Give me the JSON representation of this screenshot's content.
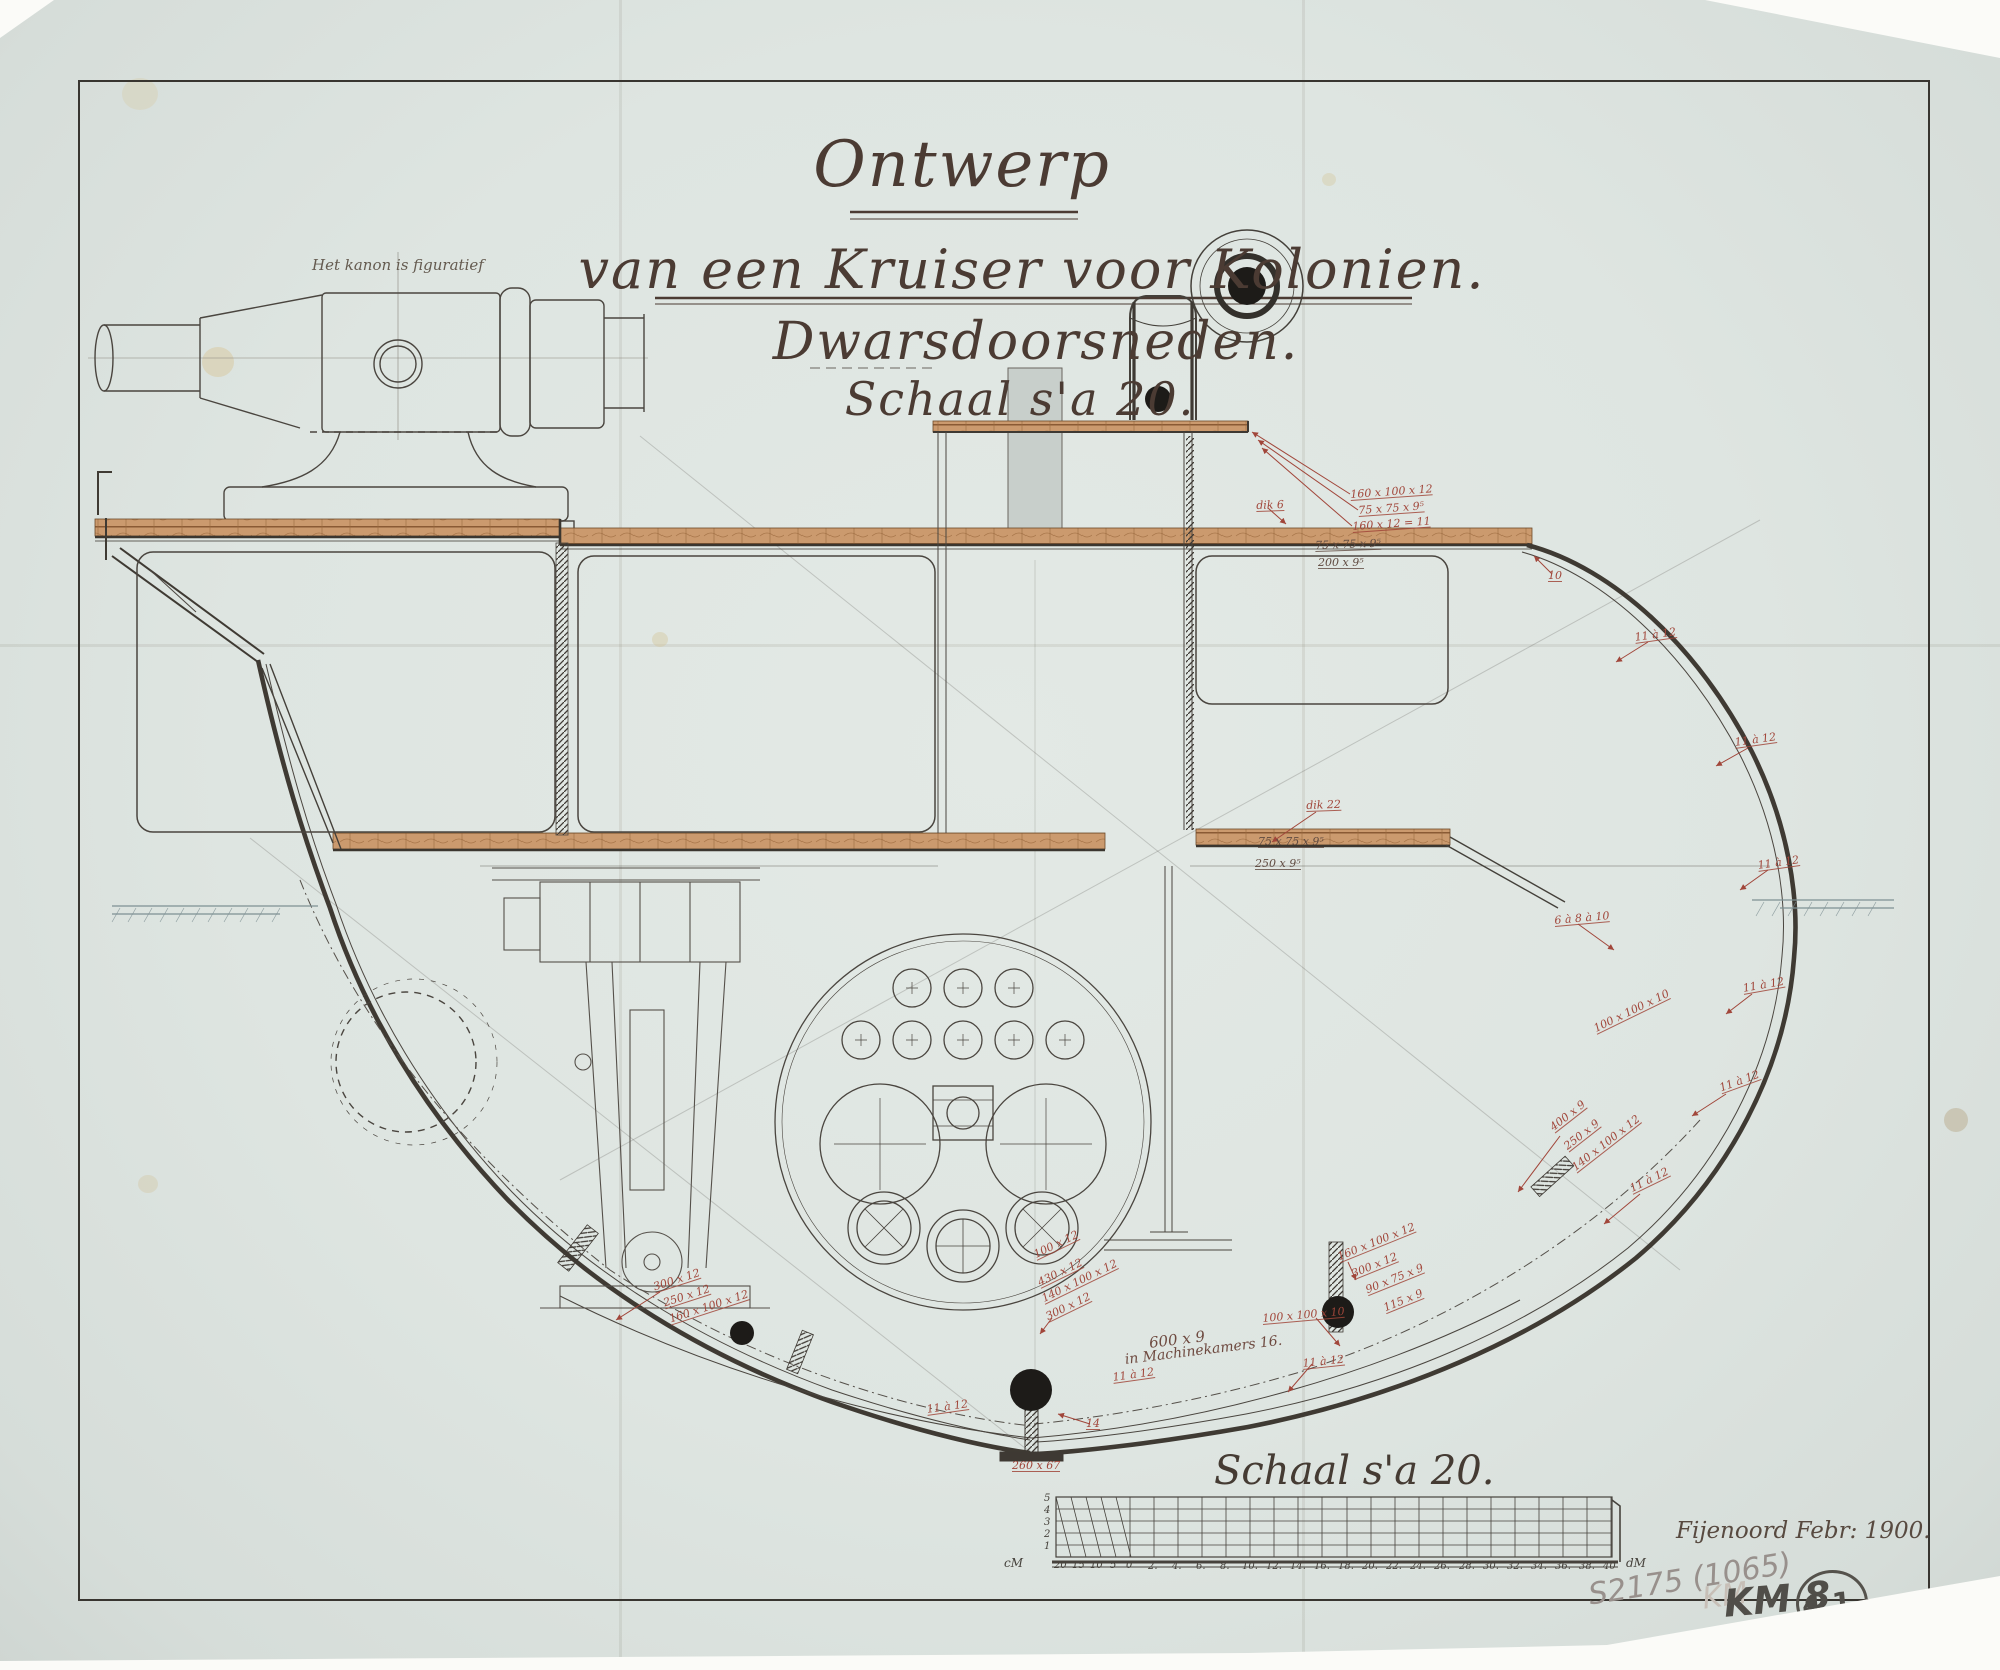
{
  "titles": {
    "line1": "Ontwerp",
    "line2": "van een Kruiser voor Kolonien.",
    "line3": "Dwarsdoorsneden.",
    "line4": "Schaal s'a 20."
  },
  "notes": {
    "cannon": "Het kanon is figuratief",
    "machine1": "600 x 9",
    "machine2": "in Machinekamers 16."
  },
  "scale_section": {
    "label": "Schaal s'a 20.",
    "signature": "Fijenoord   Febr: 1900."
  },
  "pencil": {
    "catalog": "S2175 (1065)",
    "ghost": "KM",
    "km": "KM 8",
    "circled": "4.1.",
    "extra": ".8"
  },
  "colors": {
    "paper": "#dee5e1",
    "ink": "#44403a",
    "red_ink": "#a1463a",
    "planking": "#c9976b",
    "blot": "#1d1b18",
    "pencil": "#98908c"
  },
  "annotations": [
    {
      "t": "160 x 100 x 12",
      "x": 1350,
      "y": 489,
      "r": -4
    },
    {
      "t": "75 x 75 x 9⁵",
      "x": 1358,
      "y": 505,
      "r": -4
    },
    {
      "t": "160 x 12 = 11",
      "x": 1352,
      "y": 521,
      "r": -4
    },
    {
      "t": "dik 6",
      "x": 1256,
      "y": 500,
      "r": -2
    },
    {
      "t": "75 x 75 x 9⁵",
      "x": 1315,
      "y": 540,
      "r": -2,
      "c": "dk"
    },
    {
      "t": "200 x 9⁵",
      "x": 1318,
      "y": 557,
      "r": 0,
      "c": "dk"
    },
    {
      "t": "10",
      "x": 1548,
      "y": 570,
      "r": 0
    },
    {
      "t": "11 à 12",
      "x": 1634,
      "y": 632,
      "r": -8
    },
    {
      "t": "11 à 12",
      "x": 1734,
      "y": 737,
      "r": -8
    },
    {
      "t": "11 à 12",
      "x": 1757,
      "y": 860,
      "r": -8
    },
    {
      "t": "dik 22",
      "x": 1306,
      "y": 800,
      "r": -2
    },
    {
      "t": "75 x 75 x 9⁵",
      "x": 1258,
      "y": 836,
      "r": 0,
      "c": "dk"
    },
    {
      "t": "250 x 9⁵",
      "x": 1255,
      "y": 858,
      "r": 0,
      "c": "dk"
    },
    {
      "t": "6 à 8 à 10",
      "x": 1554,
      "y": 915,
      "r": -5
    },
    {
      "t": "11 à 12",
      "x": 1742,
      "y": 983,
      "r": -10
    },
    {
      "t": "100 x 100 x 10",
      "x": 1592,
      "y": 1024,
      "r": -26
    },
    {
      "t": "11 à 12",
      "x": 1718,
      "y": 1083,
      "r": -20
    },
    {
      "t": "400 x 9",
      "x": 1548,
      "y": 1124,
      "r": -38
    },
    {
      "t": "250 x 9",
      "x": 1562,
      "y": 1143,
      "r": -38
    },
    {
      "t": "140 x 100 x 12",
      "x": 1570,
      "y": 1164,
      "r": -38
    },
    {
      "t": "11 à 12",
      "x": 1628,
      "y": 1184,
      "r": -26
    },
    {
      "t": "160 x 100 x 12",
      "x": 1336,
      "y": 1252,
      "r": -22
    },
    {
      "t": "300 x 12",
      "x": 1350,
      "y": 1269,
      "r": -22
    },
    {
      "t": "90 x 75 x 9",
      "x": 1364,
      "y": 1285,
      "r": -22
    },
    {
      "t": "115 x 9",
      "x": 1382,
      "y": 1303,
      "r": -22
    },
    {
      "t": "100 x 100 x 10",
      "x": 1262,
      "y": 1313,
      "r": -5
    },
    {
      "t": "11 à 12",
      "x": 1302,
      "y": 1358,
      "r": -6
    },
    {
      "t": "100 x 12",
      "x": 1032,
      "y": 1250,
      "r": -26
    },
    {
      "t": "430 x 12",
      "x": 1036,
      "y": 1278,
      "r": -26
    },
    {
      "t": "140 x 100 x 12",
      "x": 1040,
      "y": 1294,
      "r": -26
    },
    {
      "t": "300 x 12",
      "x": 1044,
      "y": 1312,
      "r": -26
    },
    {
      "t": "300 x 12",
      "x": 652,
      "y": 1282,
      "r": -18
    },
    {
      "t": "250 x 12",
      "x": 662,
      "y": 1298,
      "r": -18
    },
    {
      "t": "160 x 100 x 12",
      "x": 668,
      "y": 1314,
      "r": -18
    },
    {
      "t": "11 à 12",
      "x": 926,
      "y": 1404,
      "r": -8
    },
    {
      "t": "11 à 12",
      "x": 1112,
      "y": 1372,
      "r": -8
    },
    {
      "t": "14",
      "x": 1086,
      "y": 1418,
      "r": 0
    },
    {
      "t": "260 x 67",
      "x": 1012,
      "y": 1460,
      "r": 0
    }
  ],
  "scale_ticks": [
    {
      "t": "cM",
      "x": 1004,
      "y": 1558,
      "c": "unit"
    },
    {
      "t": "20",
      "x": 1054,
      "y": 1561
    },
    {
      "t": "15",
      "x": 1072,
      "y": 1561
    },
    {
      "t": "10",
      "x": 1090,
      "y": 1561
    },
    {
      "t": "5",
      "x": 1110,
      "y": 1561
    },
    {
      "t": "0",
      "x": 1126,
      "y": 1561
    },
    {
      "t": "2.",
      "x": 1148,
      "y": 1562
    },
    {
      "t": "4.",
      "x": 1172,
      "y": 1562
    },
    {
      "t": "6.",
      "x": 1196,
      "y": 1562
    },
    {
      "t": "8.",
      "x": 1220,
      "y": 1562
    },
    {
      "t": "10.",
      "x": 1242,
      "y": 1562
    },
    {
      "t": "12.",
      "x": 1266,
      "y": 1562
    },
    {
      "t": "14.",
      "x": 1290,
      "y": 1562
    },
    {
      "t": "16.",
      "x": 1314,
      "y": 1562
    },
    {
      "t": "18.",
      "x": 1338,
      "y": 1562
    },
    {
      "t": "20.",
      "x": 1362,
      "y": 1562
    },
    {
      "t": "22.",
      "x": 1386,
      "y": 1562
    },
    {
      "t": "24.",
      "x": 1410,
      "y": 1562
    },
    {
      "t": "26.",
      "x": 1434,
      "y": 1562
    },
    {
      "t": "28.",
      "x": 1459,
      "y": 1562
    },
    {
      "t": "30.",
      "x": 1483,
      "y": 1562
    },
    {
      "t": "32.",
      "x": 1507,
      "y": 1562
    },
    {
      "t": "34.",
      "x": 1531,
      "y": 1562
    },
    {
      "t": "36.",
      "x": 1555,
      "y": 1562
    },
    {
      "t": "38.",
      "x": 1579,
      "y": 1562
    },
    {
      "t": "40",
      "x": 1603,
      "y": 1562
    },
    {
      "t": "dM",
      "x": 1626,
      "y": 1558,
      "c": "unit"
    },
    {
      "t": "5",
      "x": 1044,
      "y": 1494,
      "c": "side"
    },
    {
      "t": "4",
      "x": 1044,
      "y": 1506,
      "c": "side"
    },
    {
      "t": "3",
      "x": 1044,
      "y": 1518,
      "c": "side"
    },
    {
      "t": "2",
      "x": 1044,
      "y": 1530,
      "c": "side"
    },
    {
      "t": "1",
      "x": 1044,
      "y": 1542,
      "c": "side"
    }
  ]
}
